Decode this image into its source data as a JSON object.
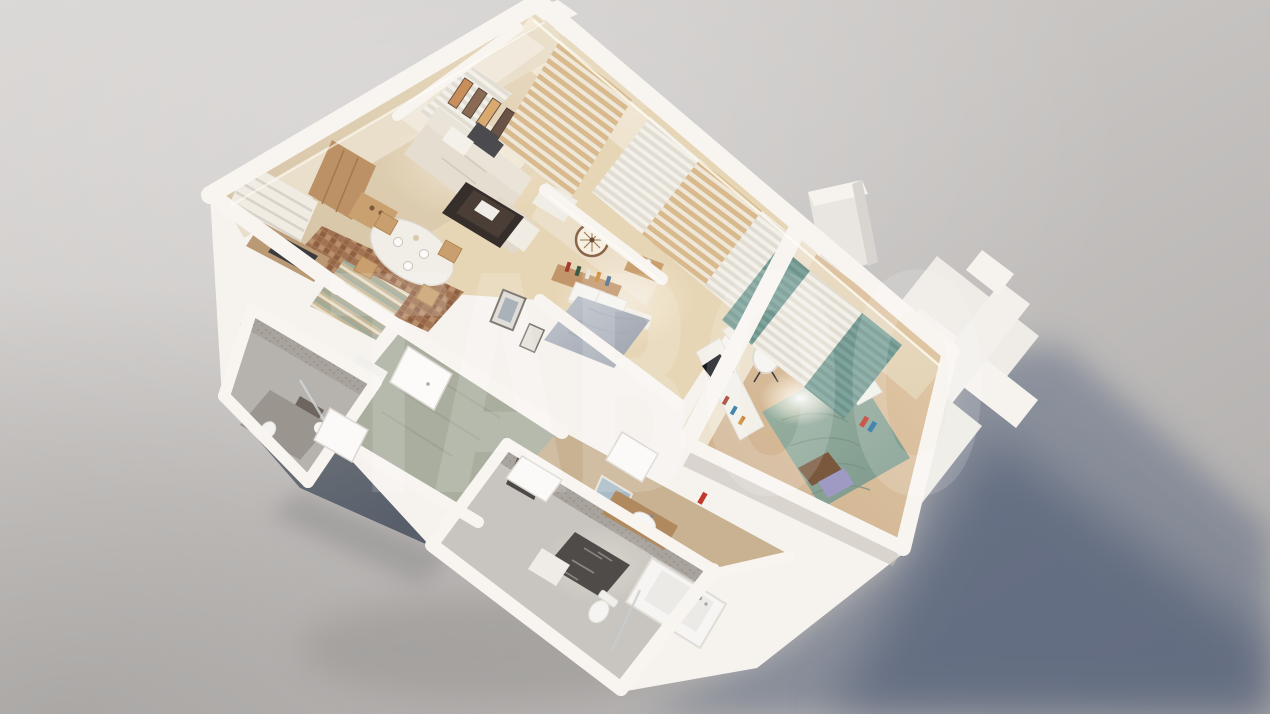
{
  "watermark": {
    "text": "TABOO",
    "color": "#ffffff",
    "opacity": 0.15
  },
  "palette": {
    "bg_light": "#d8d5d3",
    "bg_mid": "#c6c3c1",
    "bg_dark": "#a9a6a4",
    "wall_white": "#f6f3ef",
    "wall_face_warm": "#efe5d3",
    "exterior_face_dark": "#636a74",
    "shadow": "#5a6780",
    "shadow_dark": "#4a5671",
    "living_floor": "#dcc9ab",
    "bed1_floor": "#e7d6b6",
    "bed2_floor": "#dcc19e",
    "hall_floor": "#a9ae9f",
    "corridor_floor": "#c9b292",
    "small_bath_floor": "#b6b2ad",
    "bath_floor": "#c8c4bf",
    "duvet_gray": "#b4bac3",
    "duvet_green": "#8fa99a",
    "curtain_teal": "#7ea49d",
    "curtain_tan": "#d9ba8e",
    "wood_cabinet": "#bb9165",
    "sofa_beige": "#e4ddd0",
    "rug_dark": "#4f4b48",
    "mosaic_tile": "#a87a58"
  },
  "scene": {
    "type": "3d-apartment-dollhouse-render",
    "view": "aerial-oblique",
    "shadow_direction": "lower-right",
    "rooms": [
      {
        "name": "living-room-kitchen",
        "floor_color": "#dcc9ab",
        "items": [
          "corner-sofa",
          "coffee-table",
          "dining-table-chairs",
          "kitchen-cabinet",
          "cooktop",
          "window-blinds",
          "wall-art-panels",
          "tan-curtains",
          "striped-rug",
          "mosaic-tile-floor",
          "niche-sheer-curtain"
        ]
      },
      {
        "name": "bedroom-1",
        "floor_color": "#e7d6b6",
        "items": [
          "double-bed-gray-duvet",
          "headboard-shelf-books",
          "wall-clock",
          "nightstand",
          "leaning-picture-frames",
          "sheer-and-tan-curtains"
        ]
      },
      {
        "name": "bedroom-2",
        "floor_color": "#dcc19e",
        "items": [
          "double-bed-green-duvet",
          "white-pillows",
          "brown-pillow",
          "lavender-pillow",
          "media-console",
          "tv",
          "desk",
          "round-lounge-chair",
          "teal-curtains",
          "white-sheers",
          "ceiling-light-glow"
        ]
      },
      {
        "name": "bathroom",
        "floor_color": "#c8c4bf",
        "items": [
          "bathtub",
          "toilet",
          "wood-vanity-sink",
          "mirror",
          "towel-radiator",
          "dark-patterned-rug",
          "door"
        ]
      },
      {
        "name": "small-bathroom",
        "floor_color": "#b6b2ad",
        "items": [
          "shower",
          "towel",
          "mirror-light",
          "toilet",
          "vanity"
        ]
      },
      {
        "name": "hallway",
        "floor_color": "#a9ae9f",
        "items": [
          "white-door"
        ]
      },
      {
        "name": "exterior",
        "items": [
          "balcony-wall-cross",
          "roof-block",
          "cast-shadow"
        ]
      }
    ]
  }
}
